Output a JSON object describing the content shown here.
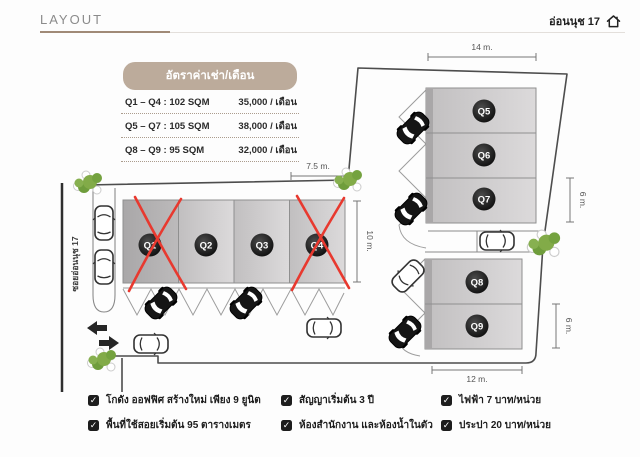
{
  "header": {
    "title": "LAYOUT",
    "location": "อ่อนนุช 17"
  },
  "price_table": {
    "title": "อัตราค่าเช่า/เดือน",
    "rows": [
      {
        "range": "Q1 – Q4 : 102 SQM",
        "price": "35,000 / เดือน"
      },
      {
        "range": "Q5 – Q7 : 105 SQM",
        "price": "38,000 / เดือน"
      },
      {
        "range": "Q8 – Q9 : 95 SQM",
        "price": "32,000 / เดือน"
      }
    ]
  },
  "plan": {
    "street": "ซอยอ่อนนุช 17",
    "units": [
      {
        "id": "Q1",
        "crossed_out": true
      },
      {
        "id": "Q2",
        "crossed_out": false
      },
      {
        "id": "Q3",
        "crossed_out": false
      },
      {
        "id": "Q4",
        "crossed_out": true
      },
      {
        "id": "Q5",
        "crossed_out": false
      },
      {
        "id": "Q6",
        "crossed_out": false
      },
      {
        "id": "Q7",
        "crossed_out": false
      },
      {
        "id": "Q8",
        "crossed_out": false
      },
      {
        "id": "Q9",
        "crossed_out": false
      }
    ],
    "dimensions": {
      "top_width": "14 m.",
      "left_width": "7.5 m.",
      "left_depth": "10 m.",
      "right_upper_depth": "6 m.",
      "right_lower_depth": "6 m.",
      "bottom_width": "12 m."
    }
  },
  "features": [
    "โกดัง ออฟฟิศ สร้างใหม่ เพียง 9 ยูนิต",
    "สัญญาเริ่มต้น 3 ปี",
    "ไฟฟ้า 7 บาท/หน่วย",
    "พื้นที่ใช้สอยเริ่มต้น 95 ตารางเมตร",
    "ห้องสำนักงาน และห้องน้ำในตัว",
    "ประปา 20 บาท/หน่วย"
  ],
  "colors": {
    "accent_tan": "#bcab9b",
    "cross_red": "#e8392f",
    "building_gray": "#cccacb",
    "tree_green": "#82ab48",
    "underline_brown": "#a08a77"
  },
  "check_glyph": "✓"
}
